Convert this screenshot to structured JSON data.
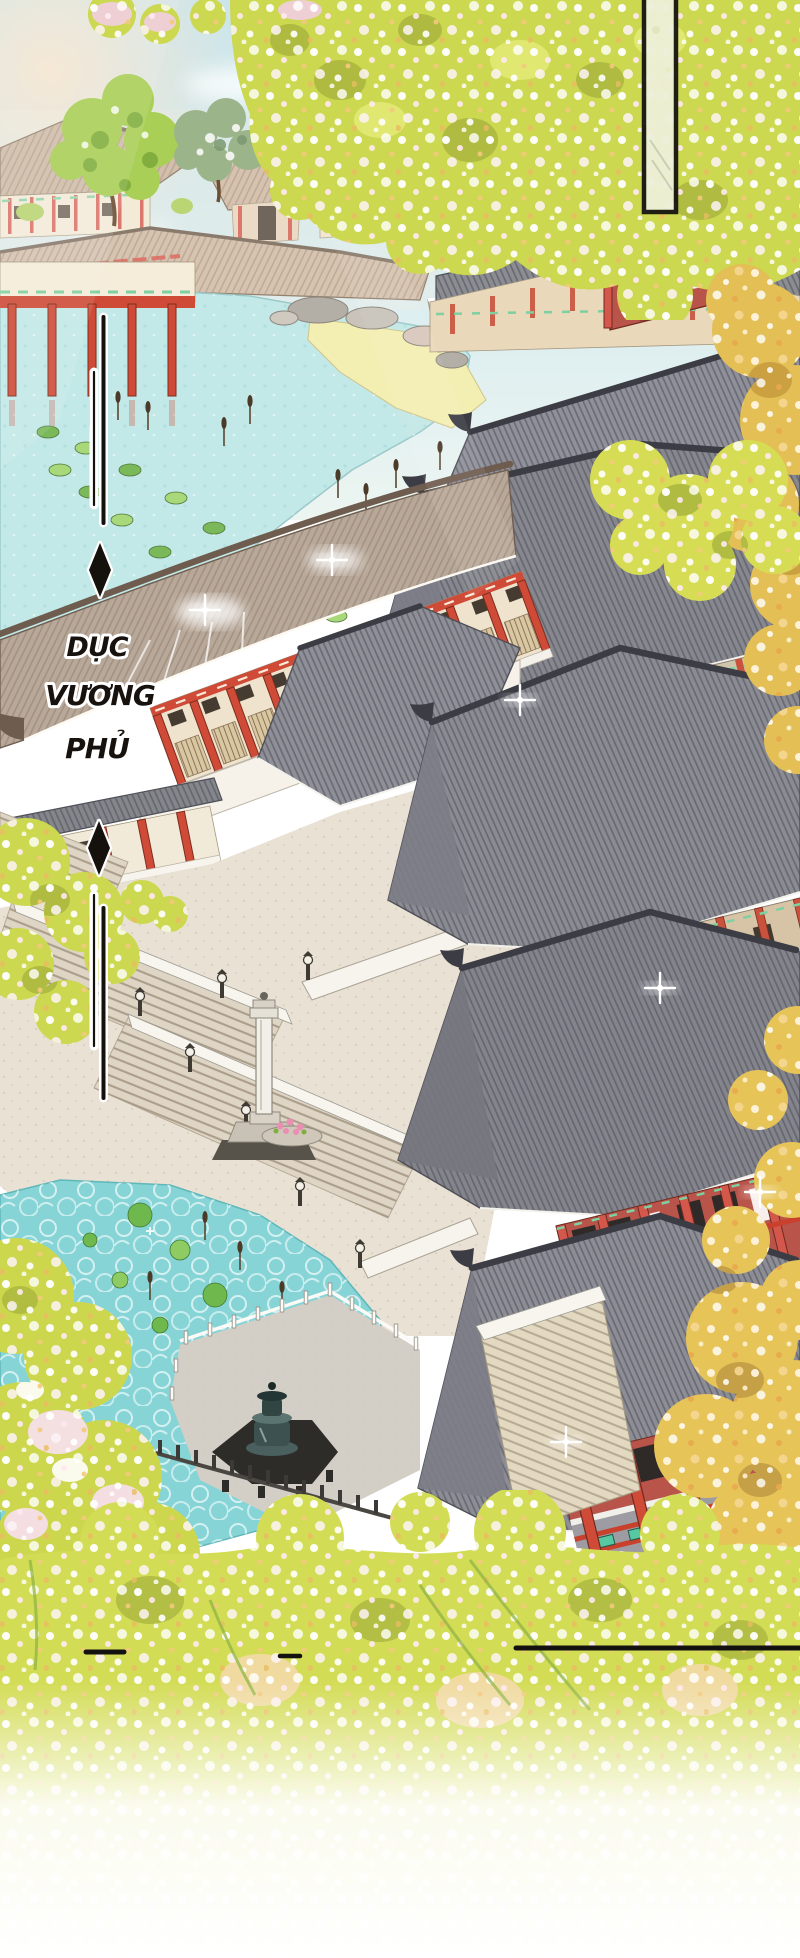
{
  "panel": {
    "kind": "manhwa-scene-panel",
    "caption_full": "DỤC VƯƠNG PHỦ",
    "caption_words": [
      "DỤC",
      "VƯƠNG",
      "PHỦ"
    ],
    "marker_glyph": "◆"
  },
  "palette": {
    "sky": "#cbe5eb",
    "water_upper": "#c2e8e7",
    "water_lower": "#86d4d6",
    "roof_slate": "#87878f",
    "roof_tan": "#b8a899",
    "pillar_red": "#cf4b37",
    "wall_cream": "#efe3cd",
    "accent_green": "#56c8a2",
    "foliage_yellow": "#ccd850",
    "foliage_gold": "#e3bf55",
    "blossom_pink": "#f6dfe9",
    "plaza_stone": "#e9e1d3",
    "ink": "#17120e",
    "outline_white": "#ffffff"
  }
}
